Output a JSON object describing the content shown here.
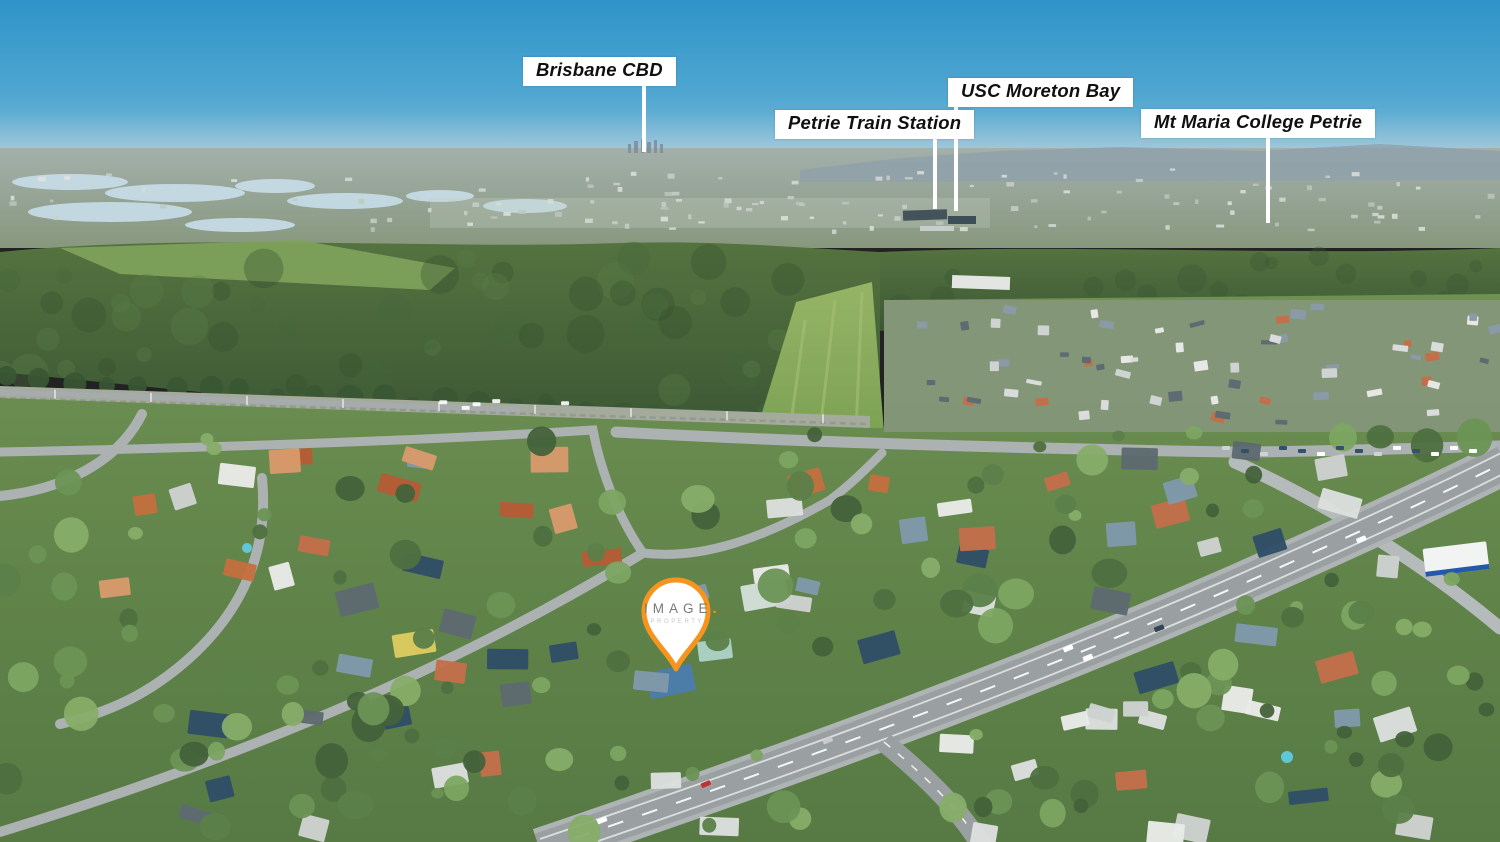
{
  "image": {
    "type": "aerial-drone-photograph",
    "scene": "Aerial suburban real-estate view with annotated landmarks, forest reserve, green fields and a main road intersection"
  },
  "annotations": {
    "labels": [
      {
        "text": "Brisbane CBD"
      },
      {
        "text": "Petrie Train Station"
      },
      {
        "text": "USC Moreton Bay"
      },
      {
        "text": "Mt Maria College Petrie"
      }
    ]
  },
  "pin": {
    "brand": "IMAGE",
    "brand_dot": ".",
    "sub_brand": "PROPERTY"
  },
  "colors": {
    "label_background": "#ffffff",
    "label_text": "#101010",
    "leader_line": "#ffffff",
    "pin_accent": "#f7941e",
    "pin_fill": "#ffffff",
    "sky_top": "#2e94c9",
    "sky_horizon": "#8cc0da",
    "forest": "#3d5837",
    "field": "#85a758",
    "road": "#9aa0a2"
  }
}
